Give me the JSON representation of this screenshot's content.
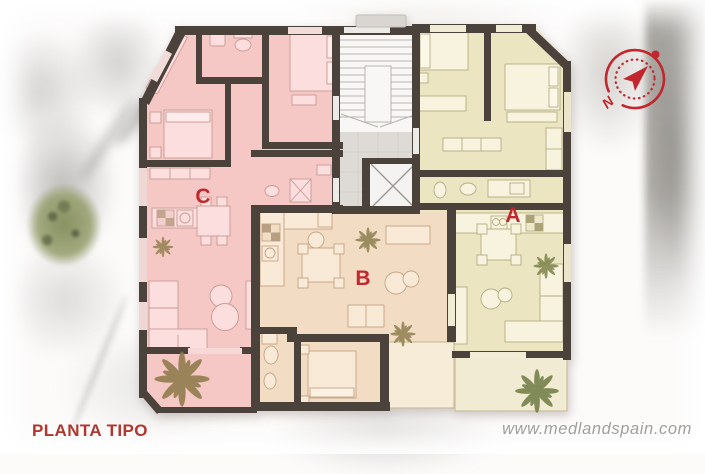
{
  "plan": {
    "title": "PLANTA TIPO",
    "apartments": [
      {
        "label": "C",
        "color": "#f6c8c5"
      },
      {
        "label": "B",
        "color": "#f3dcc4"
      },
      {
        "label": "A",
        "color": "#ebe5c2"
      }
    ]
  },
  "compass": {
    "north_label": "N",
    "color": "#c1272d"
  },
  "watermark": {
    "text": "www.medlandspain.com"
  },
  "colors": {
    "wall": "#4c423c",
    "stair": "#f8f7f5",
    "landing": "#dedbd7",
    "label": "#c1272d",
    "title": "#b2352e"
  }
}
